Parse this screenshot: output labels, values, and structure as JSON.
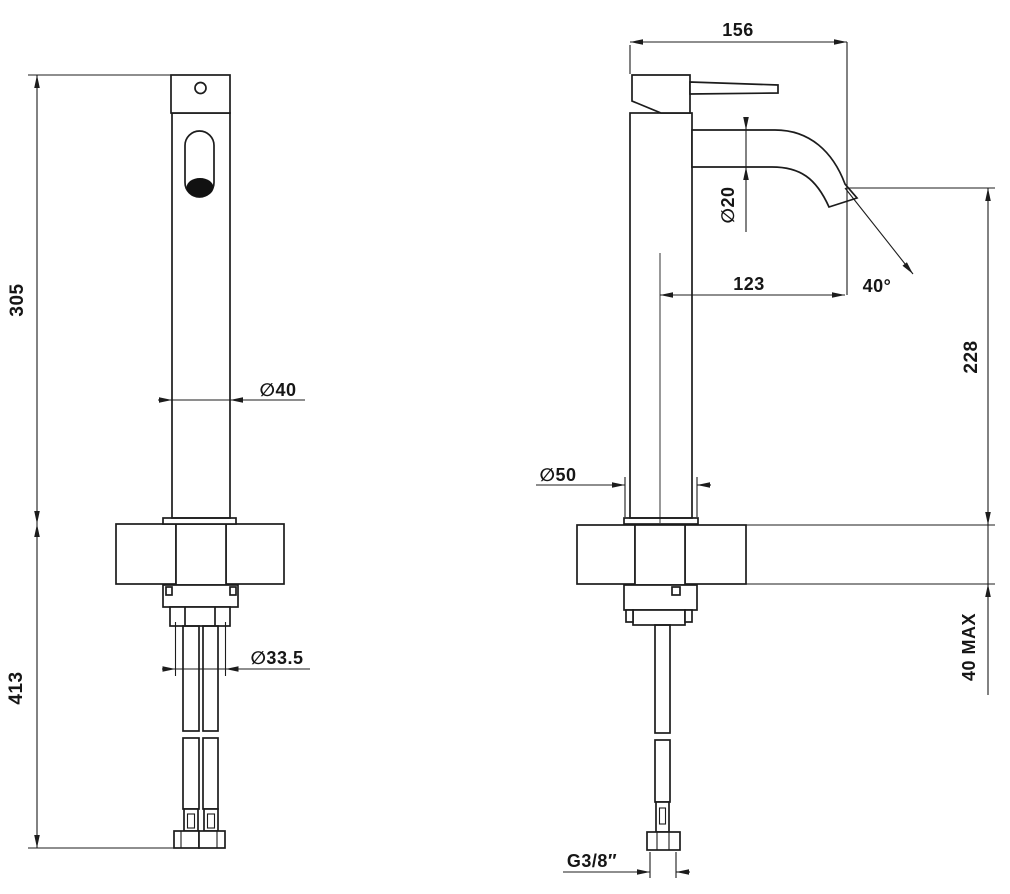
{
  "page": {
    "background": "#ffffff",
    "line_color": "#1c1c1c"
  },
  "drawing": {
    "kind": "technical dimension drawing",
    "subject": "single-lever high basin mixer tap with flexible supply hoses, front and side views",
    "views": [
      {
        "id": "front",
        "name": "front view"
      },
      {
        "id": "side",
        "name": "side view"
      }
    ],
    "labels": {
      "height_above_deck": "305",
      "height_below_deck": "413",
      "body_diameter": "∅40",
      "supply_hole_diameter": "∅33.5",
      "total_depth": "156",
      "spout_tube_diameter": "∅20",
      "spout_reach": "123",
      "spout_angle": "40°",
      "spout_outlet_height": "228",
      "base_diameter": "∅50",
      "max_deck_thickness": "40 MAX",
      "supply_thread": "G3/8″"
    }
  }
}
